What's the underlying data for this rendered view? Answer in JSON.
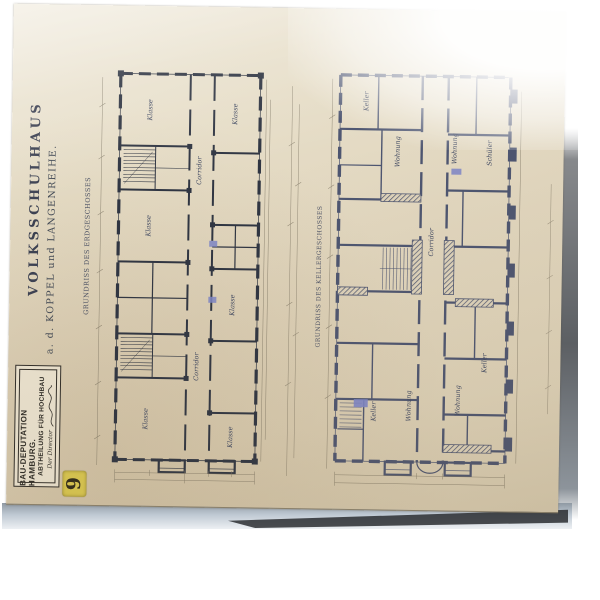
{
  "sheet": {
    "number": "9",
    "title": {
      "line1": "VOLKSSCHULHAUS",
      "line2": "a. d. KOPPEL und LANGENREIHE."
    },
    "stamp": {
      "line1": "BAU-DEPUTATION HAMBURG.",
      "line2": "ABTHEILUNG FÜR HOCHBAU",
      "line3": "Der Director"
    }
  },
  "plans": {
    "left": {
      "caption": "GRUNDRISS DES ERDGESCHOSSES",
      "labels": [
        {
          "text": "Klasse"
        },
        {
          "text": "Klasse"
        },
        {
          "text": "Corridor"
        },
        {
          "text": "Klasse"
        },
        {
          "text": "Klasse"
        },
        {
          "text": "Corridor"
        },
        {
          "text": "Klasse"
        },
        {
          "text": "Klasse"
        }
      ]
    },
    "right": {
      "caption": "GRUNDRISS DES KELLERGESCHOSSES",
      "labels": [
        {
          "text": "Keller"
        },
        {
          "text": "Wohnung"
        },
        {
          "text": "Wohnung"
        },
        {
          "text": "Schüler"
        },
        {
          "text": "Corridor"
        },
        {
          "text": "Keller"
        },
        {
          "text": "Wohnung"
        },
        {
          "text": "Wohnung"
        },
        {
          "text": "Keller"
        }
      ]
    }
  },
  "colors": {
    "background": "#ffffff",
    "paper": "#e2d8c0",
    "ink": "#2f3542",
    "ink_hatched": "#4d5570",
    "accent_blue": "#7c85c6",
    "label_yellow": "#d9c750"
  }
}
